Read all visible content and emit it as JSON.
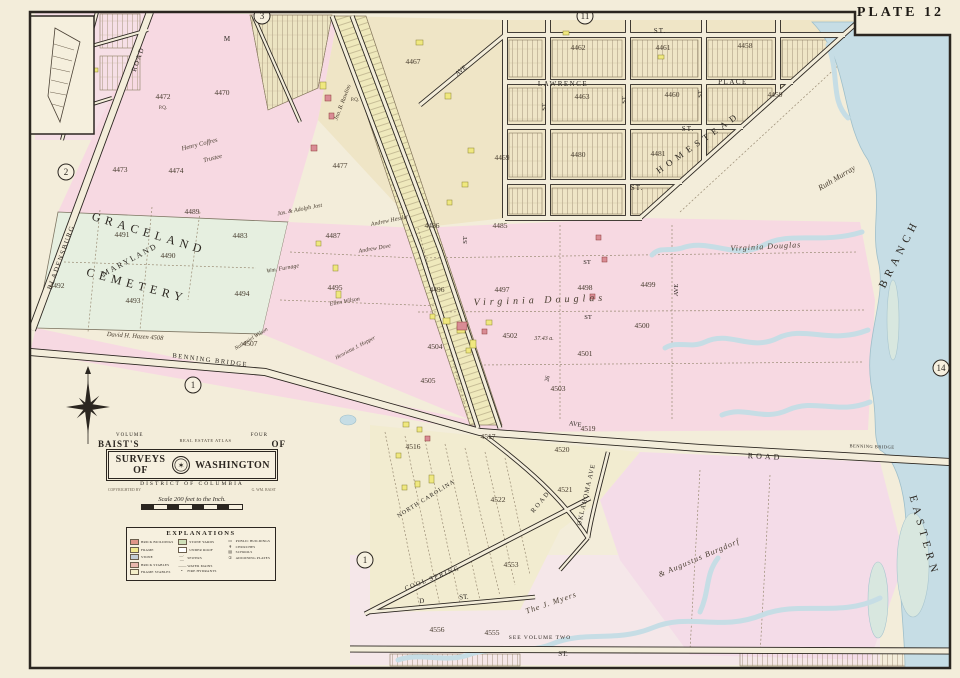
{
  "plate": {
    "label": "PLATE 12"
  },
  "cartouche": {
    "volume_left": "VOLUME",
    "volume_right": "FOUR",
    "baists": "BAIST'S",
    "arc_title": "REAL ESTATE ATLAS",
    "of": "OF",
    "banner_left": "SURVEYS OF",
    "seal_glyph": "✶",
    "banner_right": "WASHINGTON",
    "district": "DISTRICT OF COLUMBIA",
    "copyright_left": "COPYRIGHTED BY",
    "copyright_right": "G. WM. BAIST",
    "scale_text": "Scale 200 feet to the Inch."
  },
  "legend": {
    "title": "EXPLANATIONS",
    "cols": [
      [
        {
          "c": "#e09688",
          "t": "BRICK BUILDINGS"
        },
        {
          "c": "#f1e98e",
          "t": "FRAME"
        },
        {
          "c": "#c3ccd4",
          "t": "STONE"
        },
        {
          "c": "#e8b7ad",
          "t": "BRICK STABLES"
        },
        {
          "c": "#f5efc9",
          "t": "FRAME STABLES"
        }
      ],
      [
        {
          "c": "#cfe0b8",
          "t": "STONE YARDS"
        },
        {
          "c": "#ffffff",
          "t": "UNDER ROOF"
        },
        {
          "y": "—·—",
          "t": "SEWERS"
        },
        {
          "y": "——",
          "t": "WATER MAINS"
        },
        {
          "y": "•",
          "t": "FIRE HYDRANTS"
        }
      ],
      [
        {
          "y": "▭",
          "t": "PUBLIC BUILDINGS"
        },
        {
          "y": "✝",
          "t": "CHURCHES"
        },
        {
          "y": "▤",
          "t": "SCHOOLS"
        },
        {
          "y": "①",
          "t": "ADJOINING PLATES"
        }
      ]
    ]
  },
  "map": {
    "colors": {
      "paper": "#f3edda",
      "pink": "#f7d9e2",
      "tan": "#efe5c6",
      "green": "#e6efe0",
      "water": "#c6dde5",
      "strip": "#efe9bc",
      "lavender": "#f4dce8",
      "ink": "#2b2620",
      "creek": "#b7d3dc",
      "marsh": "#d8e7df"
    },
    "labels": [
      {
        "t": "BLADENSBURG",
        "x": 63,
        "y": 258,
        "r": -70,
        "s": 7,
        "f": "caps",
        "sp": 1.5
      },
      {
        "t": "ROAD",
        "x": 140,
        "y": 60,
        "r": -70,
        "s": 7,
        "f": "caps",
        "sp": 1.5
      },
      {
        "t": "M",
        "x": 227,
        "y": 41,
        "s": 7,
        "f": "caps"
      },
      {
        "t": "ST.",
        "x": 660,
        "y": 33,
        "s": 7,
        "f": "caps",
        "sp": 1
      },
      {
        "t": "LAWRENCE",
        "x": 563,
        "y": 86,
        "s": 7,
        "f": "caps",
        "sp": 1.5
      },
      {
        "t": "PLACE",
        "x": 733,
        "y": 84,
        "s": 7,
        "f": "caps",
        "sp": 1.5
      },
      {
        "t": "ST.",
        "x": 688,
        "y": 131,
        "s": 7,
        "f": "caps",
        "sp": 1
      },
      {
        "t": "ST.",
        "x": 637,
        "y": 190,
        "s": 7,
        "f": "caps",
        "sp": 1
      },
      {
        "t": "ST",
        "x": 546,
        "y": 107,
        "r": -90,
        "s": 6.5,
        "f": "caps"
      },
      {
        "t": "ST",
        "x": 626,
        "y": 100,
        "r": -90,
        "s": 6.5,
        "f": "caps"
      },
      {
        "t": "ST",
        "x": 702,
        "y": 94,
        "r": -90,
        "s": 6.5,
        "f": "caps"
      },
      {
        "t": "ST",
        "x": 467,
        "y": 240,
        "r": -90,
        "s": 6.5,
        "f": "caps"
      },
      {
        "t": "HOMESTEAD",
        "x": 700,
        "y": 145,
        "r": -35,
        "s": 9,
        "f": "caps",
        "sp": 5
      },
      {
        "t": "GRACELAND",
        "x": 148,
        "y": 237,
        "r": 17,
        "s": 12,
        "f": "caps",
        "sp": 5
      },
      {
        "t": "CEMETERY",
        "x": 136,
        "y": 289,
        "r": 15,
        "s": 12,
        "f": "caps",
        "sp": 5
      },
      {
        "t": "MARYLAND",
        "x": 131,
        "y": 262,
        "r": -28,
        "s": 8,
        "f": "caps",
        "sp": 2
      },
      {
        "t": "BENNING BRIDGE",
        "x": 210,
        "y": 362,
        "r": 7,
        "s": 6.5,
        "f": "caps",
        "sp": 1.5
      },
      {
        "t": "ROAD",
        "x": 765,
        "y": 459,
        "r": 3,
        "s": 8,
        "f": "caps",
        "sp": 3
      },
      {
        "t": "BENNING BRIDGE",
        "x": 872,
        "y": 448,
        "r": 2,
        "s": 4.5,
        "f": "caps",
        "sp": 0.5
      },
      {
        "t": "AVE",
        "x": 462,
        "y": 72,
        "r": -38,
        "s": 6.5,
        "f": "caps"
      },
      {
        "t": "AVE",
        "x": 678,
        "y": 290,
        "r": -90,
        "s": 6.5,
        "f": "caps"
      },
      {
        "t": "AVE",
        "x": 575,
        "y": 426,
        "r": 8,
        "s": 6.5,
        "f": "caps"
      },
      {
        "t": "ST",
        "x": 587,
        "y": 264,
        "s": 6.5,
        "f": "caps"
      },
      {
        "t": "ST",
        "x": 588,
        "y": 319,
        "s": 6.5,
        "f": "caps"
      },
      {
        "t": "26",
        "x": 549,
        "y": 379,
        "r": -78,
        "s": 6,
        "f": "caps"
      },
      {
        "t": "NORTH CAROLINA",
        "x": 427,
        "y": 500,
        "r": -32,
        "s": 6,
        "f": "caps",
        "sp": 1
      },
      {
        "t": "ROAD",
        "x": 542,
        "y": 503,
        "r": -50,
        "s": 6.5,
        "f": "caps",
        "sp": 2
      },
      {
        "t": "OKLAHOMA AVE",
        "x": 588,
        "y": 495,
        "r": -77,
        "s": 6.5,
        "f": "caps",
        "sp": 1
      },
      {
        "t": "COOL SPRING",
        "x": 433,
        "y": 580,
        "r": -21,
        "s": 6.5,
        "f": "caps",
        "sp": 1.5
      },
      {
        "t": "D",
        "x": 422,
        "y": 603,
        "r": -6,
        "s": 7,
        "f": "caps"
      },
      {
        "t": "ST.",
        "x": 464,
        "y": 599,
        "r": -5,
        "s": 7,
        "f": "caps"
      },
      {
        "t": "ST.",
        "x": 563,
        "y": 656,
        "s": 7,
        "f": "caps"
      },
      {
        "t": "SEE VOLUME TWO",
        "x": 540,
        "y": 639,
        "s": 5.5,
        "f": "caps",
        "sp": 1
      },
      {
        "t": "BRANCH",
        "x": 902,
        "y": 255,
        "r": -63,
        "s": 11,
        "f": "caps",
        "sp": 5
      },
      {
        "t": "EASTERN",
        "x": 921,
        "y": 537,
        "r": 74,
        "s": 11,
        "f": "caps",
        "sp": 5
      },
      {
        "t": "Ruth Murray",
        "x": 838,
        "y": 180,
        "r": -31,
        "s": 8,
        "f": "ital"
      },
      {
        "t": "Virginia Douglas",
        "x": 766,
        "y": 249,
        "r": -3,
        "s": 8,
        "f": "ital",
        "sp": 1
      },
      {
        "t": "Virginia Douglas",
        "x": 540,
        "y": 303,
        "r": -2,
        "s": 10,
        "f": "ital",
        "sp": 4
      },
      {
        "t": "The J. Myers",
        "x": 552,
        "y": 605,
        "r": -19,
        "s": 8,
        "f": "ital",
        "sp": 1
      },
      {
        "t": "& Augustus Burgdorf",
        "x": 700,
        "y": 560,
        "r": -23,
        "s": 8,
        "f": "ital",
        "sp": 1
      },
      {
        "t": "David H. Hazen 4508",
        "x": 135,
        "y": 338,
        "r": 4,
        "s": 6.5,
        "f": "ital"
      },
      {
        "t": "Henry Coffres",
        "x": 200,
        "y": 146,
        "r": -14,
        "s": 6.5,
        "f": "ital"
      },
      {
        "t": "Trustee",
        "x": 213,
        "y": 160,
        "r": -14,
        "s": 6.5,
        "f": "ital"
      },
      {
        "t": "Jno. B. Rawlins",
        "x": 344,
        "y": 103,
        "r": -69,
        "s": 6,
        "f": "ital"
      },
      {
        "t": "Jas. & Adolph Jost",
        "x": 300,
        "y": 211,
        "r": -11,
        "s": 6,
        "f": "ital"
      },
      {
        "t": "Andrew Hessler",
        "x": 390,
        "y": 222,
        "r": -12,
        "s": 6,
        "f": "ital"
      },
      {
        "t": "Andrew Dove",
        "x": 375,
        "y": 250,
        "r": -10,
        "s": 6,
        "f": "ital"
      },
      {
        "t": "Wm. Furnage",
        "x": 283,
        "y": 270,
        "r": -10,
        "s": 6,
        "f": "ital"
      },
      {
        "t": "Ellen Wilson",
        "x": 345,
        "y": 303,
        "r": -10,
        "s": 6,
        "f": "ital"
      },
      {
        "t": "Nathaniel Wilson",
        "x": 252,
        "y": 340,
        "r": -32,
        "s": 5.5,
        "f": "ital"
      },
      {
        "t": "Henrietta J. Hopper",
        "x": 356,
        "y": 349,
        "r": -28,
        "s": 5.5,
        "f": "ital"
      },
      {
        "t": "37.43 a.",
        "x": 544,
        "y": 340,
        "s": 6,
        "f": "ital"
      },
      {
        "t": "4472",
        "x": 163,
        "y": 99,
        "f": "num"
      },
      {
        "t": "4470",
        "x": 222,
        "y": 95,
        "f": "num"
      },
      {
        "t": "4473",
        "x": 120,
        "y": 172,
        "f": "num"
      },
      {
        "t": "4474",
        "x": 176,
        "y": 173,
        "f": "num"
      },
      {
        "t": "4467",
        "x": 413,
        "y": 64,
        "f": "num"
      },
      {
        "t": "4477",
        "x": 340,
        "y": 168,
        "f": "num"
      },
      {
        "t": "4469",
        "x": 502,
        "y": 160,
        "f": "num"
      },
      {
        "t": "4480",
        "x": 578,
        "y": 157,
        "f": "num"
      },
      {
        "t": "4481",
        "x": 658,
        "y": 156,
        "f": "num"
      },
      {
        "t": "4462",
        "x": 578,
        "y": 50,
        "f": "num"
      },
      {
        "t": "4461",
        "x": 663,
        "y": 50,
        "f": "num"
      },
      {
        "t": "4458",
        "x": 745,
        "y": 48,
        "f": "num"
      },
      {
        "t": "4463",
        "x": 582,
        "y": 99,
        "f": "num"
      },
      {
        "t": "4460",
        "x": 672,
        "y": 97,
        "f": "num"
      },
      {
        "t": "4459",
        "x": 775,
        "y": 97,
        "f": "num"
      },
      {
        "t": "4491",
        "x": 122,
        "y": 237,
        "f": "num"
      },
      {
        "t": "4490",
        "x": 168,
        "y": 258,
        "f": "num"
      },
      {
        "t": "4492",
        "x": 57,
        "y": 288,
        "f": "num"
      },
      {
        "t": "4493",
        "x": 133,
        "y": 303,
        "f": "num"
      },
      {
        "t": "4489",
        "x": 192,
        "y": 214,
        "f": "num"
      },
      {
        "t": "4483",
        "x": 240,
        "y": 238,
        "f": "num"
      },
      {
        "t": "4487",
        "x": 333,
        "y": 238,
        "f": "num"
      },
      {
        "t": "4486",
        "x": 432,
        "y": 228,
        "f": "num"
      },
      {
        "t": "4485",
        "x": 500,
        "y": 228,
        "f": "num"
      },
      {
        "t": "4495",
        "x": 335,
        "y": 290,
        "f": "num"
      },
      {
        "t": "4494",
        "x": 242,
        "y": 296,
        "f": "num"
      },
      {
        "t": "4507",
        "x": 250,
        "y": 346,
        "f": "num"
      },
      {
        "t": "4496",
        "x": 437,
        "y": 292,
        "f": "num"
      },
      {
        "t": "4497",
        "x": 502,
        "y": 292,
        "f": "num"
      },
      {
        "t": "4498",
        "x": 585,
        "y": 290,
        "f": "num"
      },
      {
        "t": "4499",
        "x": 648,
        "y": 287,
        "f": "num"
      },
      {
        "t": "4502",
        "x": 510,
        "y": 338,
        "f": "num"
      },
      {
        "t": "4504",
        "x": 435,
        "y": 349,
        "f": "num"
      },
      {
        "t": "4501",
        "x": 585,
        "y": 356,
        "f": "num"
      },
      {
        "t": "4500",
        "x": 642,
        "y": 328,
        "f": "num"
      },
      {
        "t": "4505",
        "x": 428,
        "y": 383,
        "f": "num"
      },
      {
        "t": "4503",
        "x": 558,
        "y": 391,
        "f": "num"
      },
      {
        "t": "4516",
        "x": 413,
        "y": 449,
        "f": "num"
      },
      {
        "t": "4517",
        "x": 488,
        "y": 439,
        "f": "num"
      },
      {
        "t": "4519",
        "x": 588,
        "y": 431,
        "f": "num"
      },
      {
        "t": "4520",
        "x": 562,
        "y": 452,
        "f": "num"
      },
      {
        "t": "4521",
        "x": 565,
        "y": 492,
        "f": "num"
      },
      {
        "t": "4522",
        "x": 498,
        "y": 502,
        "f": "num"
      },
      {
        "t": "4553",
        "x": 511,
        "y": 567,
        "f": "num"
      },
      {
        "t": "4556",
        "x": 437,
        "y": 632,
        "f": "num"
      },
      {
        "t": "4555",
        "x": 492,
        "y": 635,
        "f": "num"
      },
      {
        "t": "P.Q.",
        "x": 163,
        "y": 109,
        "s": 5,
        "f": "num"
      },
      {
        "t": "P.Q.",
        "x": 355,
        "y": 101,
        "s": 5,
        "f": "num"
      }
    ],
    "circles": [
      {
        "n": "2",
        "x": 66,
        "y": 172
      },
      {
        "n": "3",
        "x": 262,
        "y": 16
      },
      {
        "n": "11",
        "x": 585,
        "y": 16
      },
      {
        "n": "14",
        "x": 941,
        "y": 368
      },
      {
        "n": "1",
        "x": 193,
        "y": 385
      },
      {
        "n": "1",
        "x": 365,
        "y": 560
      }
    ],
    "buildings": [
      {
        "x": 320,
        "y": 82,
        "w": 6,
        "h": 7,
        "k": "f"
      },
      {
        "x": 416,
        "y": 40,
        "w": 7,
        "h": 5,
        "k": "f"
      },
      {
        "x": 445,
        "y": 93,
        "w": 6,
        "h": 6,
        "k": "f"
      },
      {
        "x": 333,
        "y": 265,
        "w": 5,
        "h": 6,
        "k": "f"
      },
      {
        "x": 336,
        "y": 291,
        "w": 5,
        "h": 7,
        "k": "f"
      },
      {
        "x": 316,
        "y": 241,
        "w": 5,
        "h": 5,
        "k": "f"
      },
      {
        "x": 443,
        "y": 318,
        "w": 7,
        "h": 6,
        "k": "f"
      },
      {
        "x": 457,
        "y": 326,
        "w": 8,
        "h": 7,
        "k": "f"
      },
      {
        "x": 470,
        "y": 340,
        "w": 6,
        "h": 8,
        "k": "f"
      },
      {
        "x": 486,
        "y": 320,
        "w": 6,
        "h": 5,
        "k": "f"
      },
      {
        "x": 430,
        "y": 314,
        "w": 5,
        "h": 5,
        "k": "f"
      },
      {
        "x": 466,
        "y": 348,
        "w": 5,
        "h": 5,
        "k": "f"
      },
      {
        "x": 403,
        "y": 422,
        "w": 6,
        "h": 5,
        "k": "f"
      },
      {
        "x": 417,
        "y": 427,
        "w": 5,
        "h": 5,
        "k": "f"
      },
      {
        "x": 429,
        "y": 475,
        "w": 5,
        "h": 8,
        "k": "f"
      },
      {
        "x": 415,
        "y": 481,
        "w": 5,
        "h": 6,
        "k": "f"
      },
      {
        "x": 396,
        "y": 453,
        "w": 5,
        "h": 5,
        "k": "f"
      },
      {
        "x": 402,
        "y": 485,
        "w": 5,
        "h": 5,
        "k": "f"
      },
      {
        "x": 563,
        "y": 31,
        "w": 6,
        "h": 4,
        "k": "f"
      },
      {
        "x": 658,
        "y": 55,
        "w": 6,
        "h": 4,
        "k": "f"
      },
      {
        "x": 468,
        "y": 148,
        "w": 6,
        "h": 5,
        "k": "f"
      },
      {
        "x": 462,
        "y": 182,
        "w": 6,
        "h": 5,
        "k": "f"
      },
      {
        "x": 447,
        "y": 200,
        "w": 5,
        "h": 5,
        "k": "f"
      },
      {
        "x": 93,
        "y": 68,
        "w": 5,
        "h": 4,
        "k": "f"
      },
      {
        "x": 325,
        "y": 95,
        "w": 6,
        "h": 6,
        "k": "b"
      },
      {
        "x": 329,
        "y": 113,
        "w": 5,
        "h": 6,
        "k": "b"
      },
      {
        "x": 311,
        "y": 145,
        "w": 6,
        "h": 6,
        "k": "b"
      },
      {
        "x": 457,
        "y": 322,
        "w": 10,
        "h": 8,
        "k": "b"
      },
      {
        "x": 425,
        "y": 436,
        "w": 5,
        "h": 5,
        "k": "b"
      },
      {
        "x": 482,
        "y": 329,
        "w": 5,
        "h": 5,
        "k": "b"
      },
      {
        "x": 596,
        "y": 235,
        "w": 5,
        "h": 5,
        "k": "b"
      },
      {
        "x": 602,
        "y": 257,
        "w": 5,
        "h": 5,
        "k": "b"
      },
      {
        "x": 590,
        "y": 294,
        "w": 5,
        "h": 5,
        "k": "b"
      }
    ]
  }
}
